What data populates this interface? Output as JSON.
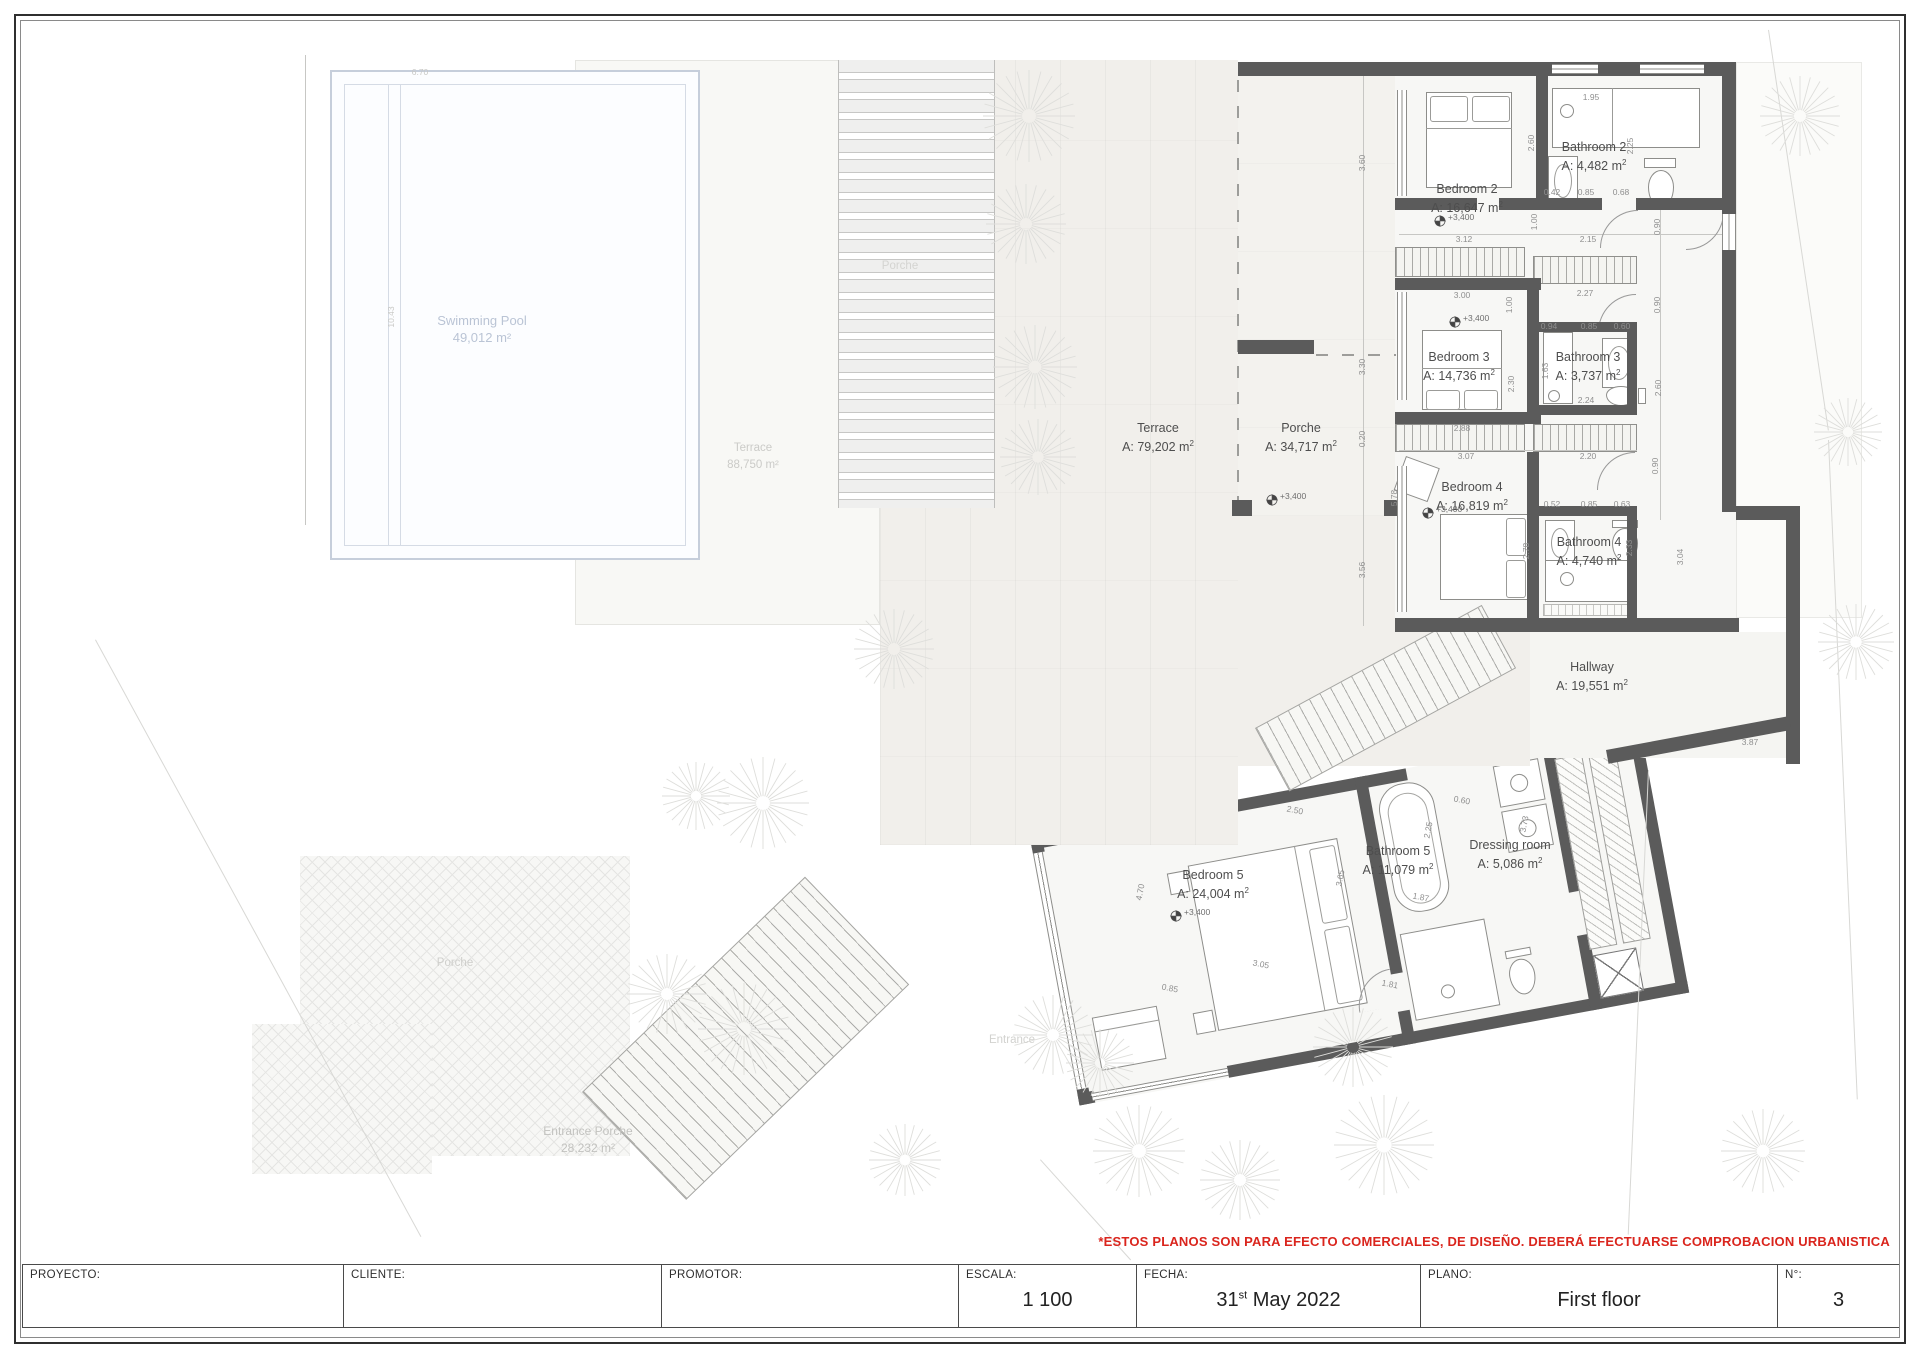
{
  "page": {
    "width": 1920,
    "height": 1358
  },
  "colors": {
    "wall": "#5b5b5b",
    "room_label": "#4e4e4e",
    "dim_text": "#8f8f8f",
    "pool_label": "#bac4d5",
    "faint_label": "#cbcbc8",
    "disclaimer_red": "#da251d"
  },
  "plan": {
    "rooms": [
      {
        "name": "Bedroom 2",
        "area": "16,647",
        "x": 1467,
        "y": 181
      },
      {
        "name": "Bathroom 2",
        "area": "4,482",
        "x": 1594,
        "y": 139
      },
      {
        "name": "Bedroom 3",
        "area": "14,736",
        "x": 1459,
        "y": 349
      },
      {
        "name": "Bathroom 3",
        "area": "3,737",
        "x": 1588,
        "y": 349
      },
      {
        "name": "Bedroom 4",
        "area": "16,819",
        "x": 1472,
        "y": 479
      },
      {
        "name": "Bathroom 4",
        "area": "4,740",
        "x": 1589,
        "y": 534
      },
      {
        "name": "Hallway",
        "area": "19,551",
        "x": 1592,
        "y": 659
      },
      {
        "name": "Bedroom 5",
        "area": "24,004",
        "x": 1213,
        "y": 867
      },
      {
        "name": "Bathroom 5",
        "area": "11,079",
        "x": 1398,
        "y": 843
      },
      {
        "name": "Dressing room",
        "area": "5,086",
        "x": 1510,
        "y": 837
      },
      {
        "name": "Terrace",
        "area": "79,202",
        "x": 1158,
        "y": 420
      },
      {
        "name": "Porche",
        "area": "34,717",
        "x": 1301,
        "y": 420
      }
    ],
    "faint_labels": [
      {
        "lines": [
          "Swimming Pool",
          "49,012 m²"
        ],
        "x": 482,
        "y": 312,
        "color": "#bac4d5",
        "size": 13
      },
      {
        "lines": [
          "Terrace",
          "88,750 m²"
        ],
        "x": 753,
        "y": 440,
        "color": "#cbcbc8",
        "size": 11.5
      },
      {
        "lines": [
          "Porche"
        ],
        "x": 900,
        "y": 258,
        "color": "#d4d4d1",
        "size": 11.5
      },
      {
        "lines": [
          "Porche"
        ],
        "x": 455,
        "y": 955,
        "color": "#cfcfcc",
        "size": 11.5
      },
      {
        "lines": [
          "Entrance Porche",
          "28,232 m²"
        ],
        "x": 588,
        "y": 1123,
        "color": "#c2c2bf",
        "size": 12
      },
      {
        "lines": [
          "Entrance"
        ],
        "x": 1012,
        "y": 1032,
        "color": "#d2d2cf",
        "size": 11.5
      }
    ],
    "dimensions": [
      {
        "t": "1.95",
        "x": 1591,
        "y": 97
      },
      {
        "t": "2.60",
        "x": 1531,
        "y": 143,
        "r": 90
      },
      {
        "t": "2.25",
        "x": 1630,
        "y": 146,
        "r": 90
      },
      {
        "t": "0.42",
        "x": 1552,
        "y": 192
      },
      {
        "t": "0.85",
        "x": 1586,
        "y": 192
      },
      {
        "t": "0.68",
        "x": 1621,
        "y": 192
      },
      {
        "t": "3.12",
        "x": 1464,
        "y": 239
      },
      {
        "t": "2.15",
        "x": 1588,
        "y": 239
      },
      {
        "t": "1.00",
        "x": 1534,
        "y": 222,
        "r": 90
      },
      {
        "t": "0.90",
        "x": 1657,
        "y": 227,
        "r": 90
      },
      {
        "t": "3.60",
        "x": 1362,
        "y": 163,
        "r": 90
      },
      {
        "t": "3.00",
        "x": 1462,
        "y": 295
      },
      {
        "t": "2.27",
        "x": 1585,
        "y": 293
      },
      {
        "t": "1.00",
        "x": 1509,
        "y": 305,
        "r": 90
      },
      {
        "t": "0.90",
        "x": 1657,
        "y": 305,
        "r": 90
      },
      {
        "t": "0.94",
        "x": 1549,
        "y": 326
      },
      {
        "t": "0.85",
        "x": 1589,
        "y": 326
      },
      {
        "t": "0.60",
        "x": 1622,
        "y": 326
      },
      {
        "t": "1.63",
        "x": 1545,
        "y": 371,
        "r": 90
      },
      {
        "t": "2.30",
        "x": 1511,
        "y": 384,
        "r": 90
      },
      {
        "t": "2.60",
        "x": 1658,
        "y": 388,
        "r": 90
      },
      {
        "t": "2.24",
        "x": 1586,
        "y": 400
      },
      {
        "t": "2.88",
        "x": 1462,
        "y": 428
      },
      {
        "t": "3.07",
        "x": 1466,
        "y": 456
      },
      {
        "t": "2.20",
        "x": 1588,
        "y": 456
      },
      {
        "t": "3.30",
        "x": 1362,
        "y": 367,
        "r": 90
      },
      {
        "t": "0.20",
        "x": 1362,
        "y": 439,
        "r": 90
      },
      {
        "t": "3.56",
        "x": 1362,
        "y": 570,
        "r": 90
      },
      {
        "t": "5.78",
        "x": 1394,
        "y": 498,
        "r": 90
      },
      {
        "t": "0.52",
        "x": 1552,
        "y": 504
      },
      {
        "t": "0.85",
        "x": 1589,
        "y": 504
      },
      {
        "t": "0.63",
        "x": 1622,
        "y": 504
      },
      {
        "t": "0.90",
        "x": 1655,
        "y": 466,
        "r": 90
      },
      {
        "t": "2.78",
        "x": 1526,
        "y": 551,
        "r": 90
      },
      {
        "t": "2.33",
        "x": 1629,
        "y": 548,
        "r": 90
      },
      {
        "t": "3.04",
        "x": 1680,
        "y": 557,
        "r": 90
      },
      {
        "t": "3.87",
        "x": 1750,
        "y": 742
      },
      {
        "t": "2.50",
        "x": 1295,
        "y": 810,
        "r": -11
      },
      {
        "t": "0.60",
        "x": 1462,
        "y": 800,
        "r": -11
      },
      {
        "t": "3.73",
        "x": 1524,
        "y": 824,
        "r": 79
      },
      {
        "t": "2.25",
        "x": 1428,
        "y": 830,
        "r": 79
      },
      {
        "t": "4.70",
        "x": 1140,
        "y": 892,
        "r": 79
      },
      {
        "t": "3.65",
        "x": 1340,
        "y": 878,
        "r": 79
      },
      {
        "t": "1.87",
        "x": 1421,
        "y": 897,
        "r": -11
      },
      {
        "t": "3.05",
        "x": 1261,
        "y": 964,
        "r": -11
      },
      {
        "t": "0.85",
        "x": 1170,
        "y": 988,
        "r": -11
      },
      {
        "t": "1.81",
        "x": 1390,
        "y": 984,
        "r": -11
      },
      {
        "t": "6.70",
        "x": 420,
        "y": 72,
        "f": true
      },
      {
        "t": "10.43",
        "x": 391,
        "y": 317,
        "r": 90,
        "f": true
      }
    ],
    "level_markers": [
      {
        "label": "+3,400",
        "x": 1440,
        "y": 220
      },
      {
        "label": "+3,400",
        "x": 1455,
        "y": 321
      },
      {
        "label": "+3,400",
        "x": 1272,
        "y": 499
      },
      {
        "label": "+3,400",
        "x": 1428,
        "y": 512
      },
      {
        "label": "+3,400",
        "x": 1176,
        "y": 915
      }
    ]
  },
  "disclaimer": {
    "text": "*ESTOS PLANOS SON PARA EFECTO COMERCIALES, DE DISEÑO. DEBERÁ EFECTUARSE COMPROBACION URBANISTICA"
  },
  "title_block": {
    "proyecto_label": "PROYECTO:",
    "cliente_label": "CLIENTE:",
    "promotor_label": "PROMOTOR:",
    "escala_label": "ESCALA:",
    "escala_value": "1 100",
    "fecha_label": "FECHA:",
    "fecha_day": "31",
    "fecha_sup": "st",
    "fecha_rest": " May 2022",
    "plano_label": "PLANO:",
    "plano_value": "First floor",
    "num_label": "N°:",
    "num_value": "3"
  }
}
